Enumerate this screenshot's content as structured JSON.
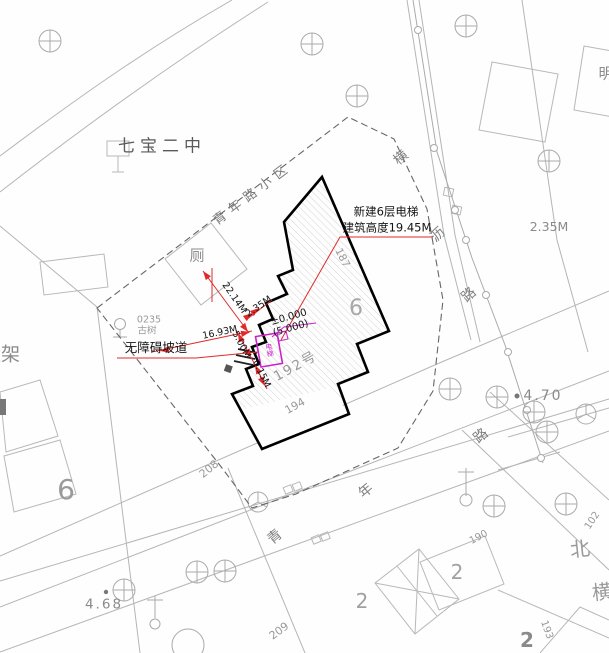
{
  "labels": {
    "school": "七宝二中",
    "neighborhood": "青年路小区",
    "toilet": "厕",
    "ancient_tree_id": "0235",
    "ancient_tree": "古树",
    "ramp": "无障碍坡道",
    "left_edge_cut": "栓架",
    "top_right_cut": "明"
  },
  "annotation": {
    "line1": "新建6层电梯",
    "line2": "建筑高度19.45M"
  },
  "elevator": {
    "label": "电梯"
  },
  "dimensions": {
    "d22_14": "22.14M",
    "d2_35": "2.35M",
    "d16_93": "16.93M",
    "d5_00": "5.00M",
    "d0_15": "0.15M"
  },
  "levels": {
    "relative": "±0.000",
    "absolute": "(5.000)"
  },
  "spot_elevations": {
    "road_east": "2.35M",
    "east": "4.70",
    "southwest": "4.68"
  },
  "house_numbers": {
    "n187": "187",
    "n190": "190",
    "n192": "192号",
    "n193": "193",
    "n194": "194",
    "n102": "102",
    "n208": "208",
    "n209": "209"
  },
  "block_numbers": {
    "in_building": "6",
    "west_block": "6",
    "block2_a": "2",
    "block2_b": "2",
    "block2_c": "2"
  },
  "roads": {
    "qingnian": [
      "青",
      "年",
      "路"
    ],
    "hengli": [
      "横",
      "沥",
      "路"
    ],
    "beiheng": [
      "北",
      "横"
    ]
  },
  "colors": {
    "red": "#e02a2a",
    "magenta": "#cc22cc",
    "outline": "#000000",
    "road_line": "#b5b5b5",
    "building_line": "#b8b8b8",
    "hatch": "#c9c9c9",
    "dark_text": "#1a1a1a",
    "gray_text": "#999999"
  }
}
